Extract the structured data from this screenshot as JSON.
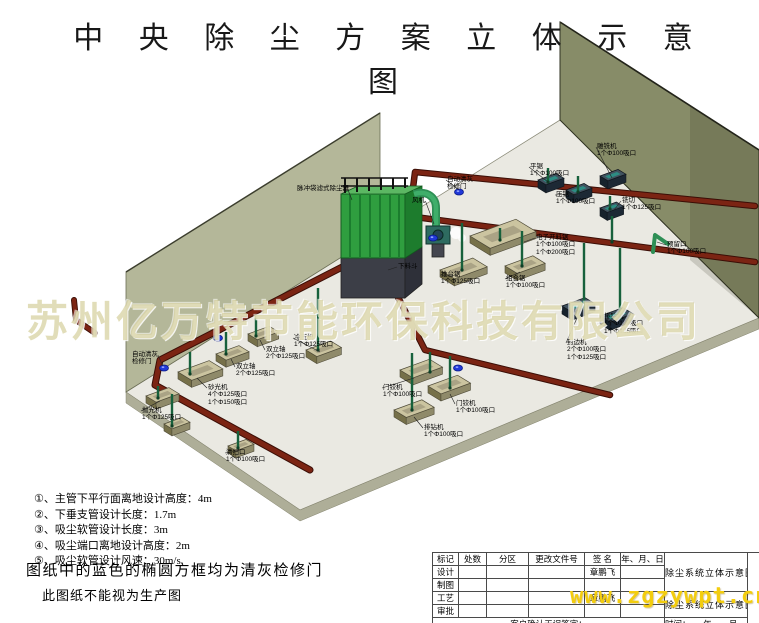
{
  "page": {
    "title": "中 央 除 尘 方 案 立 体 示 意 图"
  },
  "watermarks": {
    "company": "苏州亿万特节能环保科技有限公司",
    "url": "www.zgzywpt.cn"
  },
  "notes": {
    "lines": [
      "①、主管下平行面离地设计高度：4m",
      "②、下垂支管设计长度：1.7m",
      "③、吸尘软管设计长度：3m",
      "④、吸尘端口离地设计高度：2m",
      "⑤、吸尘软管设计风速：30m/s"
    ],
    "blue_doors": "图纸中的蓝色的椭圆方框均为清灰检修门",
    "warning": "此图纸不能视为生产图"
  },
  "diagram": {
    "labels": [
      {
        "x": 297,
        "y": 185,
        "lines": [
          "脉冲袋滤式除尘器"
        ],
        "leader": [
          352,
          200
        ]
      },
      {
        "x": 412,
        "y": 197,
        "lines": [
          "风机"
        ],
        "leader": [
          434,
          224
        ]
      },
      {
        "x": 447,
        "y": 176,
        "lines": [
          "自动清灰",
          "检修门"
        ],
        "leader": [
          459,
          190
        ]
      },
      {
        "x": 398,
        "y": 263,
        "lines": [
          "下料斗"
        ],
        "leader": [
          388,
          270
        ]
      },
      {
        "x": 530,
        "y": 163,
        "lines": [
          "平锯",
          "1个Φ100吸口"
        ],
        "leader": [
          548,
          182
        ]
      },
      {
        "x": 556,
        "y": 191,
        "lines": [
          "压锯",
          "1个Φ100吸口"
        ],
        "leader": [
          578,
          194
        ]
      },
      {
        "x": 597,
        "y": 143,
        "lines": [
          "雕铣机",
          "1个Φ100吸口"
        ],
        "leader": [
          612,
          178
        ]
      },
      {
        "x": 622,
        "y": 197,
        "lines": [
          "铣切",
          "1个Φ125吸口"
        ],
        "leader": [
          614,
          210
        ]
      },
      {
        "x": 667,
        "y": 241,
        "lines": [
          "预留口",
          "1个Φ100吸口"
        ],
        "leader": [
          657,
          242
        ]
      },
      {
        "x": 536,
        "y": 234,
        "lines": [
          "电子开料锯",
          "1个Φ100吸口",
          "1个Φ200吸口"
        ],
        "leader": [
          524,
          242
        ]
      },
      {
        "x": 441,
        "y": 271,
        "lines": [
          "推台锯",
          "1个Φ125吸口"
        ],
        "leader": [
          458,
          276
        ]
      },
      {
        "x": 506,
        "y": 275,
        "lines": [
          "组合锯",
          "1个Φ100吸口"
        ],
        "leader": [
          520,
          272
        ]
      },
      {
        "x": 567,
        "y": 339,
        "lines": [
          "封边机",
          "2个Φ100吸口",
          "1个Φ125吸口"
        ],
        "leader": [
          577,
          318
        ]
      },
      {
        "x": 604,
        "y": 313,
        "lines": [
          "排钻机",
          "1个Φ100吸口",
          "1个Φ125吸口"
        ],
        "leader": [
          616,
          324
        ]
      },
      {
        "x": 383,
        "y": 384,
        "lines": [
          "门铰机",
          "1个Φ100吸口"
        ],
        "leader": [
          414,
          378
        ]
      },
      {
        "x": 456,
        "y": 400,
        "lines": [
          "门铰机",
          "1个Φ100吸口"
        ],
        "leader": [
          450,
          394
        ]
      },
      {
        "x": 424,
        "y": 424,
        "lines": [
          "排钻机",
          "1个Φ100吸口"
        ],
        "leader": [
          414,
          417
        ]
      },
      {
        "x": 294,
        "y": 334,
        "lines": [
          "冷压机",
          "1个Φ125吸口"
        ],
        "leader": [
          320,
          352
        ]
      },
      {
        "x": 266,
        "y": 346,
        "lines": [
          "双立轴",
          "2个Φ125吸口"
        ],
        "leader": [
          260,
          340
        ]
      },
      {
        "x": 236,
        "y": 363,
        "lines": [
          "双立轴",
          "2个Φ125吸口"
        ],
        "leader": [
          231,
          359
        ]
      },
      {
        "x": 208,
        "y": 384,
        "lines": [
          "砂光机",
          "4个Φ125吸口",
          "1个Φ150吸口"
        ],
        "leader": [
          197,
          378
        ]
      },
      {
        "x": 132,
        "y": 351,
        "lines": [
          "自动清灰",
          "检修门"
        ],
        "leader": [
          163,
          366
        ]
      },
      {
        "x": 142,
        "y": 407,
        "lines": [
          "抛光机",
          "1个Φ125吸口"
        ],
        "leader": [
          160,
          401
        ]
      },
      {
        "x": 226,
        "y": 449,
        "lines": [
          "清扫口",
          "1个Φ100吸口"
        ],
        "leader": [
          240,
          450
        ]
      }
    ]
  },
  "titleblock": {
    "header": [
      "标记",
      "处数",
      "分区",
      "更改文件号",
      "签 名",
      "年、月、日"
    ],
    "rows": [
      {
        "label": "设计",
        "sign": "章鹏飞"
      },
      {
        "label": "制图",
        "sign": ""
      },
      {
        "label": "工艺",
        "sign": "章鹏飞"
      },
      {
        "label": "审批",
        "sign": ""
      }
    ],
    "drawing_title_1": "除尘系统立体示意图",
    "drawing_title_2": "除尘系统立体示意图",
    "customer_sign": "客户确认无误签字：",
    "manufacturer_sign": "生厂商确认无误签字：",
    "time_row_1": "时间：　　年　　月　　日",
    "time_row_2": "时间：　　年　　月　　日"
  },
  "colors": {
    "pipe_main": "#7b2413",
    "collector_green": "#2f9e3f",
    "wall_right": "#878c68",
    "wall_left": "#b2b596",
    "floor": "#eae9e2",
    "access_door_blue": "#2038d8",
    "watermark_yellow": "#f3cd0e"
  }
}
